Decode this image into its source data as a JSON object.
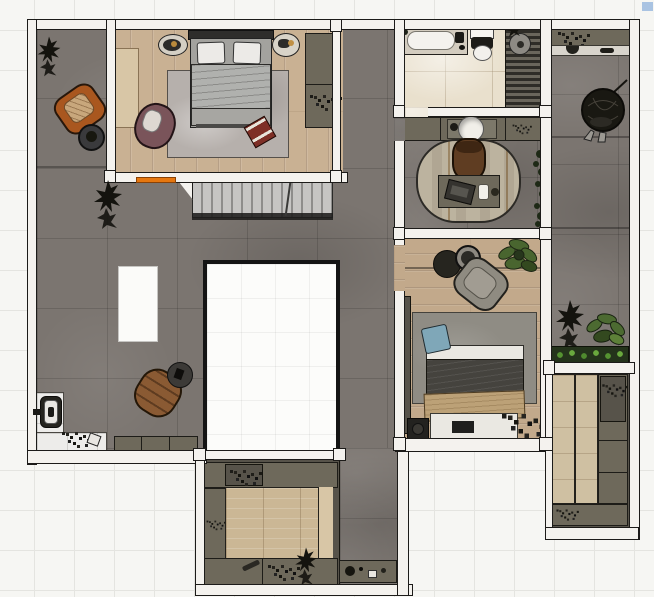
{
  "app": {
    "view": "floor-plan-top-view-render",
    "visible_text": [],
    "background": "white-tile-grid"
  },
  "colors": {
    "bg": "#f6f6f3",
    "grid": "#e4e4e0",
    "wall": "#f4f2ee",
    "line": "#1c1b19",
    "concrete": "#7b7570",
    "wood1": "#c9b193",
    "wood2": "#c2a98b",
    "woodpanel": "#d8c6a6",
    "marble": "#e9e0cd",
    "entry": "#edecea",
    "voidfill": "#fcfcfa",
    "olive": "#6e695b",
    "olive2": "#57534a",
    "rug1": "#b6b0ac",
    "rug2": "#8f8c84",
    "stair1": "#c6c5c3",
    "stair2": "#8e8d8b",
    "orange": "#e6770f",
    "chairorange": "#a9571f",
    "chairbrown": "#8a5a33",
    "chairmauve": "#7a545a",
    "chairgray": "#8f8b81",
    "deskchair": "#5f3d22",
    "headboard": "#2e2d2b",
    "duvet1": "#b0b1ae",
    "pillow": "#eceae7",
    "bedframe": "#a3a29e",
    "duvet2": "#45433e",
    "blanket": "#bca177",
    "sheet": "#eae8e2",
    "bluepillow": "#7fa7b8",
    "plantergreen": "#24331b",
    "green1": "#49652f",
    "green2": "#2c3c20",
    "dark": "#1a1913",
    "showercol": "#4f4c44",
    "tub": "#f4f2ee",
    "tandeck": "#d3ccbf",
    "ringtable": "#2b2a26",
    "artifactblue": "#a9c3e2"
  },
  "rooms": [
    {
      "id": "terrace-strip",
      "floor": "concrete"
    },
    {
      "id": "master-bedroom",
      "floor": "wood",
      "items": [
        "double-bed",
        "pillows",
        "nightstand-left",
        "nightstand-right",
        "area-rug",
        "mauve-armchair",
        "red-ottoman",
        "wardrobe",
        "light-wood-panel"
      ]
    },
    {
      "id": "stairs",
      "items": [
        "stair-treads",
        "break-line",
        "landing-wedge"
      ]
    },
    {
      "id": "living-area",
      "floor": "concrete",
      "items": [
        "white-island",
        "leather-armchair",
        "round-side-table",
        "dark-plant",
        "low-cabinet",
        "entry-door",
        "shoes"
      ]
    },
    {
      "id": "void-room",
      "floor": "white-empty"
    },
    {
      "id": "corridor",
      "floor": "concrete",
      "items": [
        "bottom-cabinet",
        "small-items"
      ]
    },
    {
      "id": "bathroom",
      "floor": "marble",
      "items": [
        "bathtub",
        "toilet",
        "shower-slats",
        "shower-stool"
      ]
    },
    {
      "id": "vanity-hall",
      "items": [
        "vanity-counter",
        "round-sink",
        "faucet"
      ]
    },
    {
      "id": "study",
      "floor": "concrete",
      "items": [
        "oval-rug",
        "desk",
        "laptop",
        "mug",
        "office-chair",
        "wall-plants"
      ]
    },
    {
      "id": "bedroom-2",
      "floor": "wood",
      "items": [
        "bed",
        "blue-pillow",
        "dark-duvet",
        "tan-blanket",
        "area-rug",
        "gray-armchair",
        "round-tables",
        "potted-plant",
        "wardrobe-strip",
        "speaker",
        "scatter-plant"
      ]
    },
    {
      "id": "balcony-right",
      "floor": "concrete",
      "items": [
        "top-shelf",
        "dark-round-object",
        "dark-bush",
        "green-plant",
        "planter-box"
      ]
    },
    {
      "id": "closet-right",
      "items": [
        "wood-panels",
        "olive-shelves",
        "speckled-box"
      ]
    },
    {
      "id": "closet-bottom",
      "items": [
        "wood-platform",
        "olive-cabinets",
        "speckled-items",
        "dark-plant"
      ]
    }
  ]
}
